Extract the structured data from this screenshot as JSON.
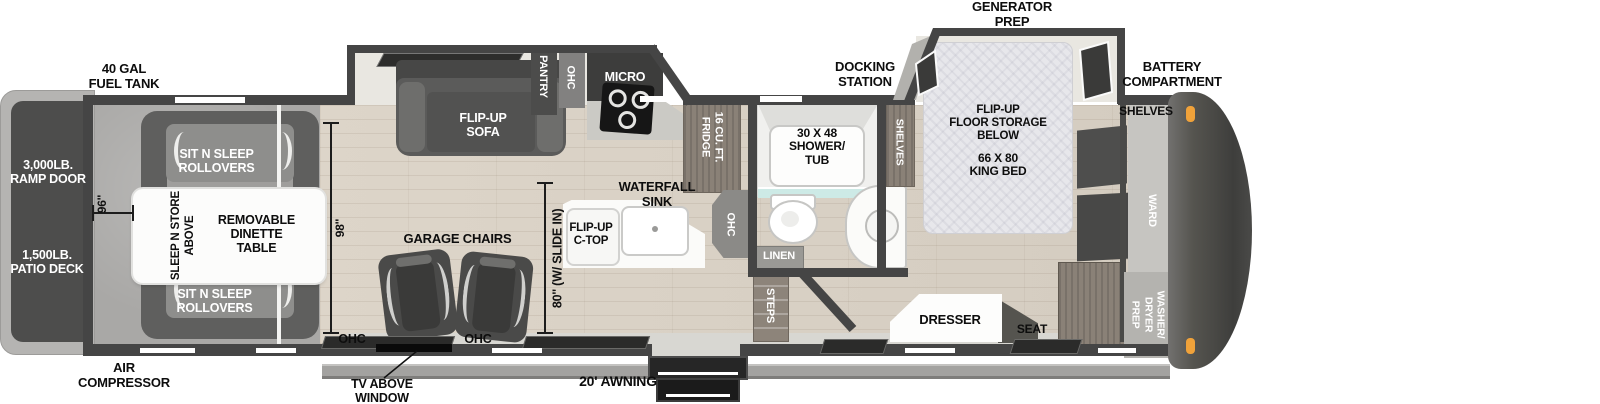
{
  "plan": {
    "exterior": {
      "fuel_tank": "40 GAL\nFUEL TANK",
      "generator_prep": "GENERATOR\nPREP",
      "docking_station": "DOCKING\nSTATION",
      "battery_compartment": "BATTERY\nCOMPARTMENT",
      "air_compressor": "AIR\nCOMPRESSOR",
      "tv_above_window": "TV ABOVE\nWINDOW",
      "awning": "20' AWNING",
      "ramp_door": "3,000LB.\nRAMP DOOR",
      "patio_deck": "1,500LB.\nPATIO DECK"
    },
    "garage": {
      "sit_n_sleep_top": "SIT N SLEEP\nROLLOVERS",
      "sit_n_sleep_bottom": "SIT N SLEEP\nROLLOVERS",
      "sleep_n_store": "SLEEP N STORE\nABOVE",
      "dinette_table": "REMOVABLE\nDINETTE\nTABLE",
      "garage_chairs": "GARAGE CHAIRS",
      "ohc_left": "OHC",
      "ohc_right": "OHC",
      "dim_width": "96''"
    },
    "living": {
      "flip_up_sofa": "FLIP-UP\nSOFA",
      "dim_interior": "98''",
      "dim_slide": "80'' (W/ SLIDE IN)"
    },
    "kitchen": {
      "pantry": "PANTRY",
      "ohc_upper": "OHC",
      "micro": "MICRO",
      "fridge": "16 CU. FT.\nFRIDGE",
      "waterfall_sink": "WATERFALL\nSINK",
      "flip_up_ctop": "FLIP-UP\nC-TOP",
      "ohc_island": "OHC"
    },
    "bath": {
      "shower_tub": "30 X 48\nSHOWER/\nTUB",
      "linen": "LINEN",
      "steps": "STEPS",
      "shelves": "SHELVES"
    },
    "bedroom": {
      "floor_storage": "FLIP-UP\nFLOOR STORAGE\nBELOW",
      "king_bed": "66 X 80\nKING BED",
      "dresser": "DRESSER",
      "seat": "SEAT",
      "ward": "WARD",
      "washer_dryer_prep": "WASHER/\nDRYER\nPREP",
      "shelves": "SHELVES"
    },
    "colors": {
      "wall": "#454545",
      "wood_floor": "#d9d1c5",
      "carpet": "#a9a8a6",
      "slide_interior": "#e9e7e1",
      "accent_marker": "#f0a23a",
      "shower_glass": "#cdeae6"
    }
  }
}
